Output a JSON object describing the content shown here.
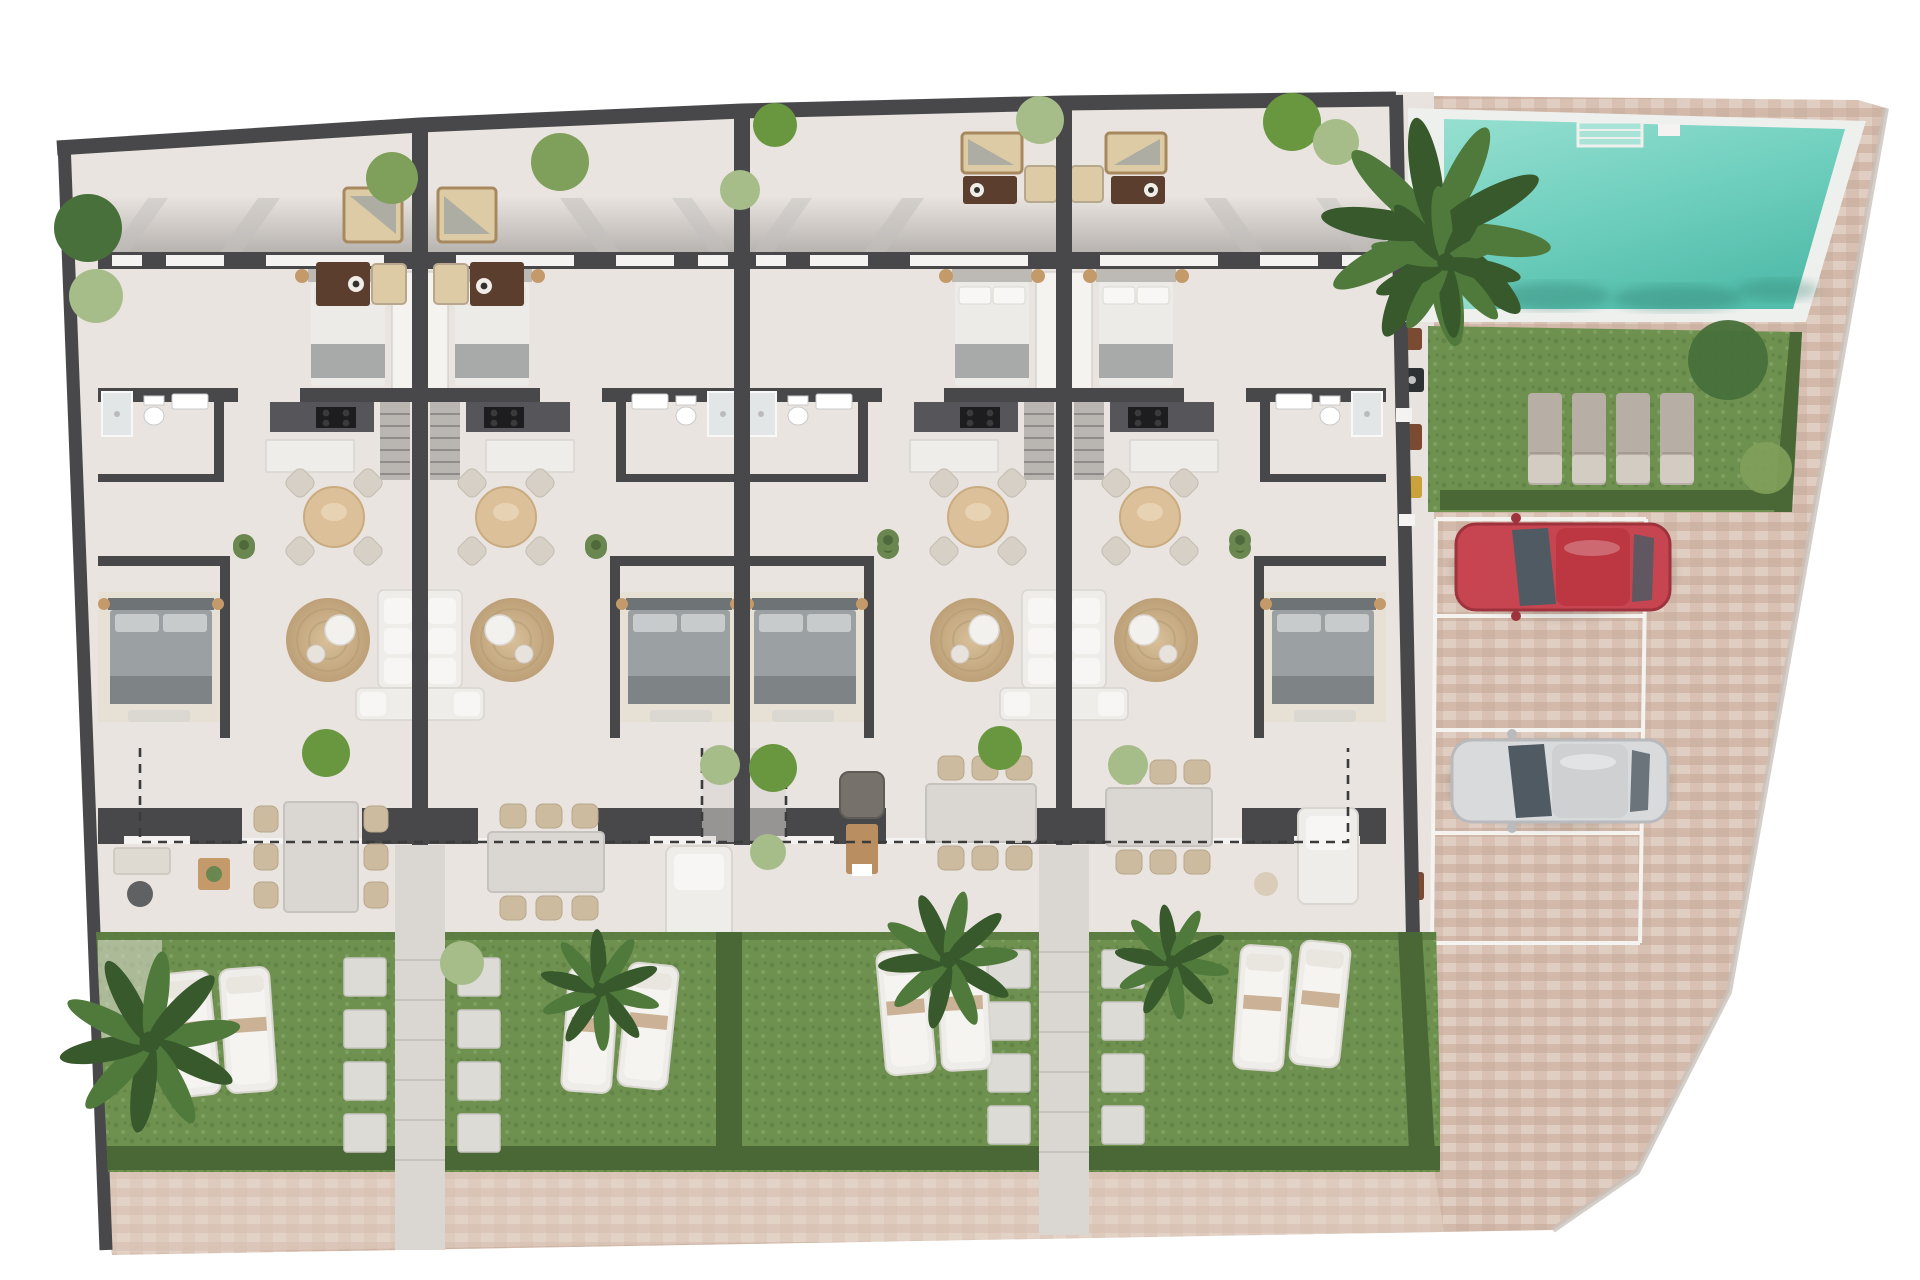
{
  "scene": {
    "kind": "architectural-site-plan",
    "view": "top-down-3d-render",
    "description": "Ground floor plan of a row of four mirrored townhouse units with private gardens, a communal swimming pool, lawn with sun loungers, and a brick-paved driveway with four parking bays (red car and silver car parked).",
    "visible_text": []
  },
  "colors": {
    "background": "#ffffff",
    "wall": "#48484b",
    "floor": "#e9e4df",
    "terraceShadow": "#8f8c8a",
    "windowWhite": "#f4f3f1",
    "deckStrip": "#e8e3de",
    "poolDeck": "#eef0ee",
    "poolLight": "#96dfd0",
    "poolMid": "#6fcfbe",
    "poolDeep": "#54bdab",
    "poolShadow": "#2f7a6b",
    "grassA": "#6e9150",
    "grassB": "#628447",
    "grassSpeck": "#7ea163",
    "hedge": "#4a6836",
    "lawnTrim": "#5b7a41",
    "path": "#dad7d3",
    "pathStep": "#c6c3bf",
    "stone": "#dcdbd6",
    "stoneEdge": "#c7c6c0",
    "brickA": "#d8c1b2",
    "brickB": "#cdb3a3",
    "brickC": "#e0cec2",
    "brickD": "#d2b9aa",
    "walkTint": "#e7d8cc",
    "parkLine": "#f4f3ef",
    "carRed": "#c64550",
    "carRedDark": "#9e333d",
    "carRedRoof": "#bd3742",
    "carSilver": "#d9dadc",
    "carSilverDark": "#b9babd",
    "carGlass": "#4f5a63",
    "sofaCream": "#ddcba6",
    "sofaBack": "#a8895f",
    "tableBrown": "#5b3e2e",
    "bedWhite": "#edebe7",
    "bedThrow": "#a8aaa9",
    "headboardLight": "#bdb9b4",
    "bedGray": "#9ba1a3",
    "bedGrayDark": "#7e8486",
    "headboardGray": "#6e7376",
    "woodTable": "#dcc09a",
    "woodTableEdge": "#c9ab80",
    "chairBeige": "#cdbb9f",
    "chairBeigeDark": "#b7a78c",
    "furnWhite": "#efedea",
    "furnWhiteEdge": "#d9d5cf",
    "rug1": "#d8c09a",
    "rug2": "#bda077",
    "kitchenCounter": "#56565a",
    "cooktop": "#1d1d1f",
    "deskWood": "#b98f62",
    "chairDark": "#5f6163",
    "plantGreen": "#6b8750",
    "plantDark": "#4f6a3a",
    "treeBright": "#69973f",
    "treeMid": "#7fa05a",
    "treeDark": "#47703a",
    "treeLight": "#a6bd8a",
    "palmLeaf": "#4f7a3c",
    "palmLeafDark": "#37592b",
    "sideTableTan": "#c49a6b",
    "dash": "#3b3b3b",
    "mahogany": "#7a4a33",
    "yellowItem": "#c9a23c",
    "edgeGray": "#c9c2ba"
  },
  "building": {
    "units": 4,
    "arrangement": "two mirrored pairs sharing entry paths",
    "unit_features": [
      "roof terrace with corner sofa, armchair and coffee table",
      "double bedroom with wardrobe and bedside tables",
      "bathroom with sink, toilet and shower",
      "staircase",
      "kitchen with cooktop and island",
      "round dining table with four chairs",
      "living area with round jute rug, coffee tables and corner sofa",
      "second double bedroom",
      "rear terrace with six-seat dining table and desk or lounge sofa",
      "private lawn with two sun loungers and stepping stones"
    ]
  },
  "amenities": {
    "swimming_pool": {
      "shape": "rectangular",
      "features": [
        "white deck border",
        "corner steps",
        "ladder",
        "overhanging palm"
      ]
    },
    "communal_lawn": {
      "sun_loungers": 4
    },
    "parking": {
      "bays": 4,
      "occupied": 2,
      "cars": [
        {
          "color": "red"
        },
        {
          "color": "silver"
        }
      ]
    },
    "paving": [
      "brick driveway",
      "brick walkway along gardens",
      "side service strip with mats and barbecue"
    ]
  },
  "landscape": {
    "garden_sun_loungers": 8,
    "palm_trees": 6,
    "bushes_and_trees": 18,
    "stepping_stones": 16,
    "hedges": true,
    "dashed_terrace_boundary": true
  }
}
